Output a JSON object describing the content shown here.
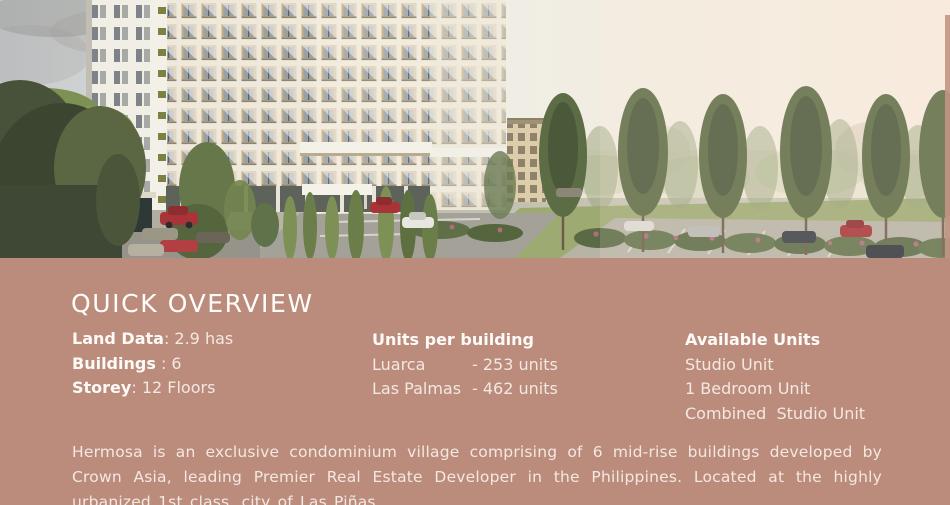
{
  "overview": {
    "title": "QUICK OVERVIEW",
    "facts": [
      {
        "label": "Land Data",
        "rest": ": 2.9 has"
      },
      {
        "label": "Buildings",
        "rest": " : 6"
      },
      {
        "label": "Storey",
        "rest": ": 12 Floors"
      }
    ],
    "units_per_building": {
      "heading": "Units per building",
      "rows": [
        {
          "name": "Luarca",
          "value": "- 253 units"
        },
        {
          "name": "Las Palmas",
          "value": "- 462 units"
        }
      ]
    },
    "available_units": {
      "heading": "Available Units",
      "items": [
        "Studio Unit",
        "1 Bedroom Unit",
        "Combined  Studio Unit"
      ]
    },
    "description": "Hermosa is an exclusive condominium village comprising of 6 mid-rise buildings developed by Crown Asia, leading Premier Real Estate Developer in the Philippines. Located at the highly urbanized 1st class, city of Las Piñas."
  },
  "hero": {
    "subject": "aerial-render-of-condominium-village"
  },
  "colors": {
    "panel_bg": "#bb8c7b",
    "heading_text": "#fffdfb",
    "body_text": "#f3e8e2",
    "sky_left": "#c6c9cb",
    "sky_right": "#f8ecde",
    "facade_tan": "#c7ad84",
    "tree_dark": "#47523a",
    "tree_light": "#7e9154"
  }
}
